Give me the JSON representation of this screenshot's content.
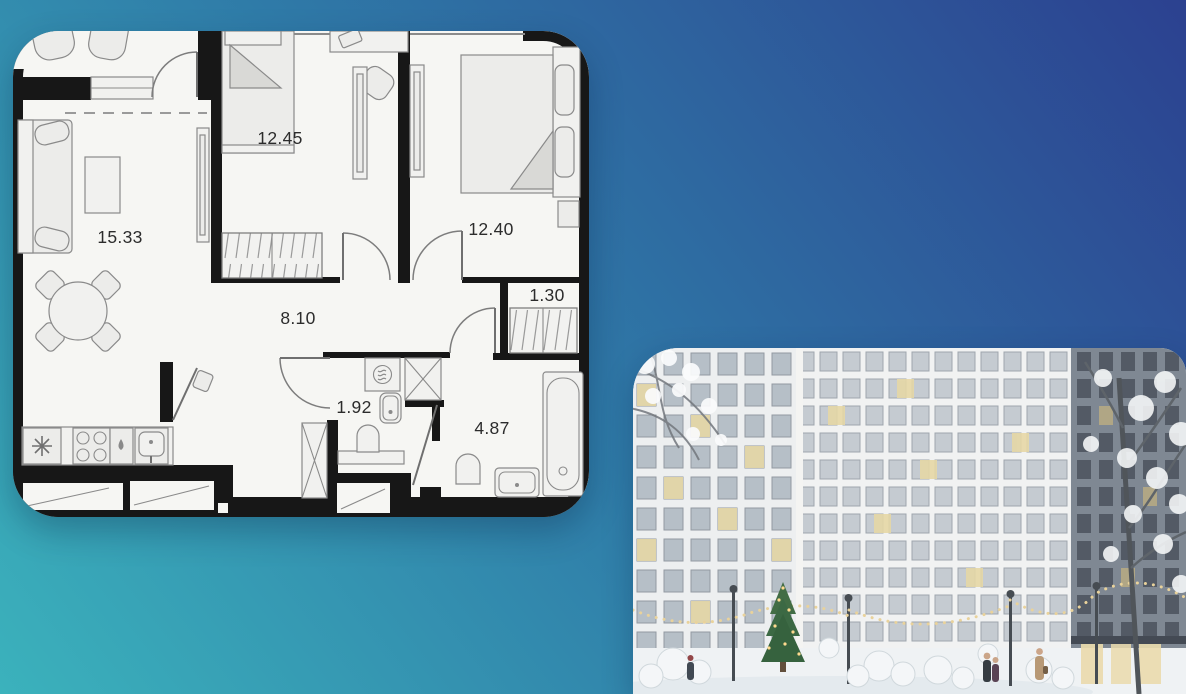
{
  "page": {
    "background_gradient": [
      "#3bb2bc",
      "#2f7ba8",
      "#2c4190"
    ]
  },
  "floor_plan": {
    "card_background": "#f6f6f3",
    "wall_color": "#171717",
    "rooms": [
      {
        "id": "living-room",
        "area": "15.33"
      },
      {
        "id": "bedroom-1",
        "area": "12.45"
      },
      {
        "id": "bedroom-2",
        "area": "12.40"
      },
      {
        "id": "hallway",
        "area": "8.10"
      },
      {
        "id": "wardrobe",
        "area": "1.30"
      },
      {
        "id": "wc",
        "area": "1.92"
      },
      {
        "id": "bathroom",
        "area": "4.87"
      }
    ]
  },
  "photo": {
    "scene": "Snowy residential courtyard: white grid-facade towers, gray tower with snow-covered trees, christmas tree, string lights, people walking",
    "palette": {
      "building_light": "#edeff0",
      "building_mid": "#f1f2f2",
      "building_dark": "#79828e",
      "snow": "#eff2f4",
      "lit_window": "#e5d6a2",
      "tree_green": "#38663c"
    }
  }
}
